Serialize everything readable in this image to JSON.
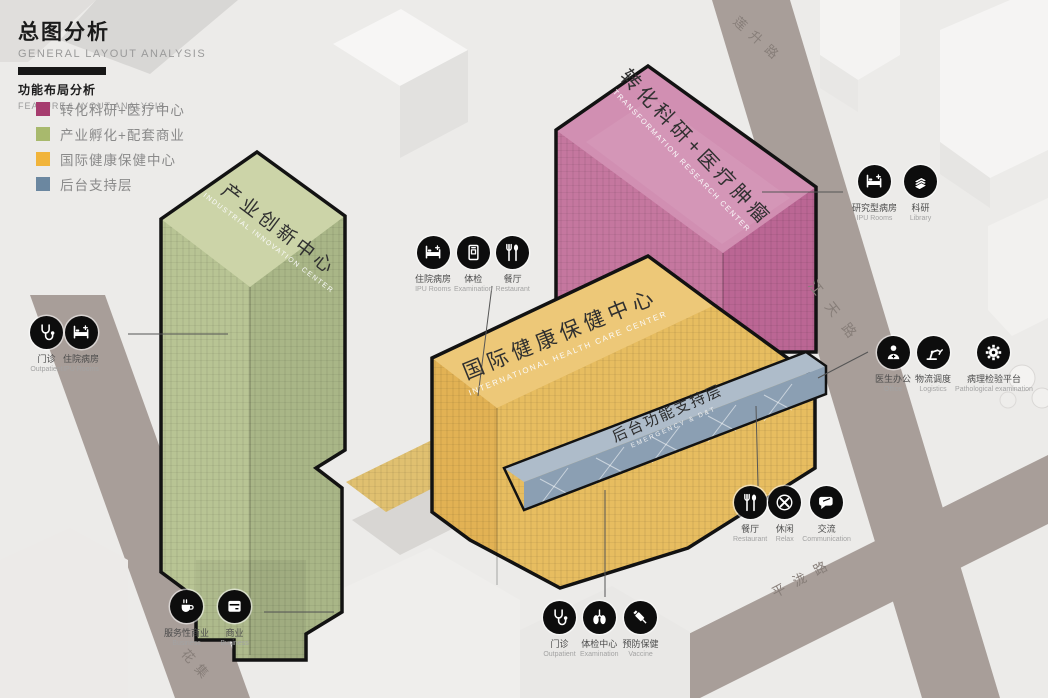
{
  "header": {
    "title_zh": "总图分析",
    "title_en": "GENERAL LAYOUT ANALYSIS",
    "subtitle_zh": "功能布局分析",
    "subtitle_en": "FEATURE LAYOUT ANALYSIS"
  },
  "legend": {
    "items": [
      {
        "label": "转化科研+医疗中心",
        "color": "#a63c6e"
      },
      {
        "label": "产业孵化+配套商业",
        "color": "#a8b96d"
      },
      {
        "label": "国际健康保健中心",
        "color": "#f1b43a"
      },
      {
        "label": "后台支持层",
        "color": "#6b87a0"
      }
    ]
  },
  "buildings": [
    {
      "id": "green",
      "name_zh": "产业创新中心",
      "name_en": "INDUSTRIAL INNOVATION CENTER",
      "color": "#b8c494"
    },
    {
      "id": "pink",
      "name_zh": "转化科研+医疗肿瘤",
      "name_en": "TRANSFORMATION RESEARCH CENTER",
      "color": "#c5779f"
    },
    {
      "id": "yellow",
      "name_zh": "国际健康保健中心",
      "name_en": "INTERNATIONAL HEALTH CARE CENTER",
      "color": "#e2b254"
    },
    {
      "id": "blue",
      "name_zh": "后台功能支持层",
      "name_en": "EMERGENCY & D&T",
      "color": "#8b9fb3"
    }
  ],
  "roads": [
    {
      "name": "莲升路"
    },
    {
      "name": "江天路"
    },
    {
      "name": "平泷路"
    },
    {
      "name": "花集"
    }
  ],
  "icon_groups": {
    "left": [
      {
        "icon": "stethoscope-icon",
        "zh": "门诊",
        "en": "Outpatient"
      },
      {
        "icon": "bed-icon",
        "zh": "住院病房",
        "en": "IPU Rooms"
      }
    ],
    "top_middle": [
      {
        "icon": "bed-icon",
        "zh": "住院病房",
        "en": "IPU Rooms"
      },
      {
        "icon": "scanner-icon",
        "zh": "体检",
        "en": "Examination"
      },
      {
        "icon": "cutlery-icon",
        "zh": "餐厅",
        "en": "Restaurant"
      }
    ],
    "top_right": [
      {
        "icon": "bed-icon",
        "zh": "研究型病房",
        "en": "IPU Rooms"
      },
      {
        "icon": "books-icon",
        "zh": "科研",
        "en": "Library"
      }
    ],
    "right": [
      {
        "icon": "doctor-icon",
        "zh": "医生办公",
        "en": "Office"
      },
      {
        "icon": "robot-arm-icon",
        "zh": "物流调度",
        "en": "Logistics"
      },
      {
        "icon": "gear-icon",
        "zh": "病理检验平台",
        "en": "Pathological examination"
      }
    ],
    "bottom_right": [
      {
        "icon": "cutlery-icon",
        "zh": "餐厅",
        "en": "Restaurant"
      },
      {
        "icon": "relax-icon",
        "zh": "休闲",
        "en": "Relax"
      },
      {
        "icon": "chat-icon",
        "zh": "交流",
        "en": "Communication"
      }
    ],
    "bottom_center": [
      {
        "icon": "stethoscope-icon",
        "zh": "门诊",
        "en": "Outpatient"
      },
      {
        "icon": "lungs-icon",
        "zh": "体检中心",
        "en": "Examination"
      },
      {
        "icon": "syringe-icon",
        "zh": "预防保健",
        "en": "Vaccine"
      }
    ],
    "bottom_left": [
      {
        "icon": "coffee-icon",
        "zh": "服务性商业",
        "en": "Business"
      },
      {
        "icon": "shop-icon",
        "zh": "商业",
        "en": "Business"
      }
    ]
  }
}
